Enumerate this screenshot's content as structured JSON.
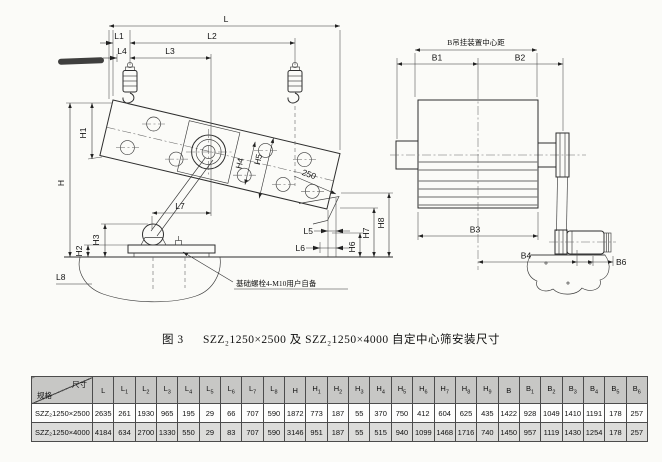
{
  "figure": {
    "fig_label": "图 3",
    "title": "SZZ₂1250×2500 及 SZZ₂1250×4000 自定中心筛安装尺寸"
  },
  "side_view": {
    "dims": {
      "L": "L",
      "L1": "L1",
      "L2": "L2",
      "L3": "L3",
      "L4": "L4",
      "L5": "L5",
      "L6": "L6",
      "L7": "L7",
      "L8": "L8",
      "H": "H",
      "H1": "H1",
      "H2": "H2",
      "H3": "H3",
      "H4": "H4",
      "H5": "H5",
      "H6": "H6",
      "H7": "H7",
      "H8": "H8",
      "dim_250": "250"
    },
    "note": "基础螺栓4-M10用户自备"
  },
  "plan_view": {
    "center_distance_label": "B吊挂装置中心距",
    "dims": {
      "B1": "B1",
      "B2": "B2",
      "B3": "B3",
      "B4": "B4",
      "B6": "B6"
    }
  },
  "table": {
    "corner": {
      "top": "尺寸",
      "bottom": "规格"
    },
    "columns": [
      "L",
      "L1",
      "L2",
      "L3",
      "L4",
      "L5",
      "L6",
      "L7",
      "L8",
      "H",
      "H1",
      "H2",
      "H3",
      "H4",
      "H5",
      "H6",
      "H7",
      "H8",
      "H9",
      "B",
      "B1",
      "B2",
      "B3",
      "B4",
      "B5",
      "B6"
    ],
    "rows": [
      {
        "spec": "SZZ₂1250×2500",
        "values": [
          2635,
          261,
          1930,
          965,
          195,
          29,
          66,
          707,
          590,
          1872,
          773,
          187,
          55,
          370,
          750,
          412,
          604,
          625,
          435,
          1422,
          928,
          1049,
          1410,
          1191,
          178,
          257
        ]
      },
      {
        "spec": "SZZ₂1250×4000",
        "values": [
          4184,
          634,
          2700,
          1330,
          550,
          29,
          83,
          707,
          590,
          3146,
          951,
          187,
          55,
          515,
          940,
          1099,
          1468,
          1716,
          740,
          1450,
          957,
          1119,
          1430,
          1254,
          178,
          257
        ]
      }
    ]
  }
}
